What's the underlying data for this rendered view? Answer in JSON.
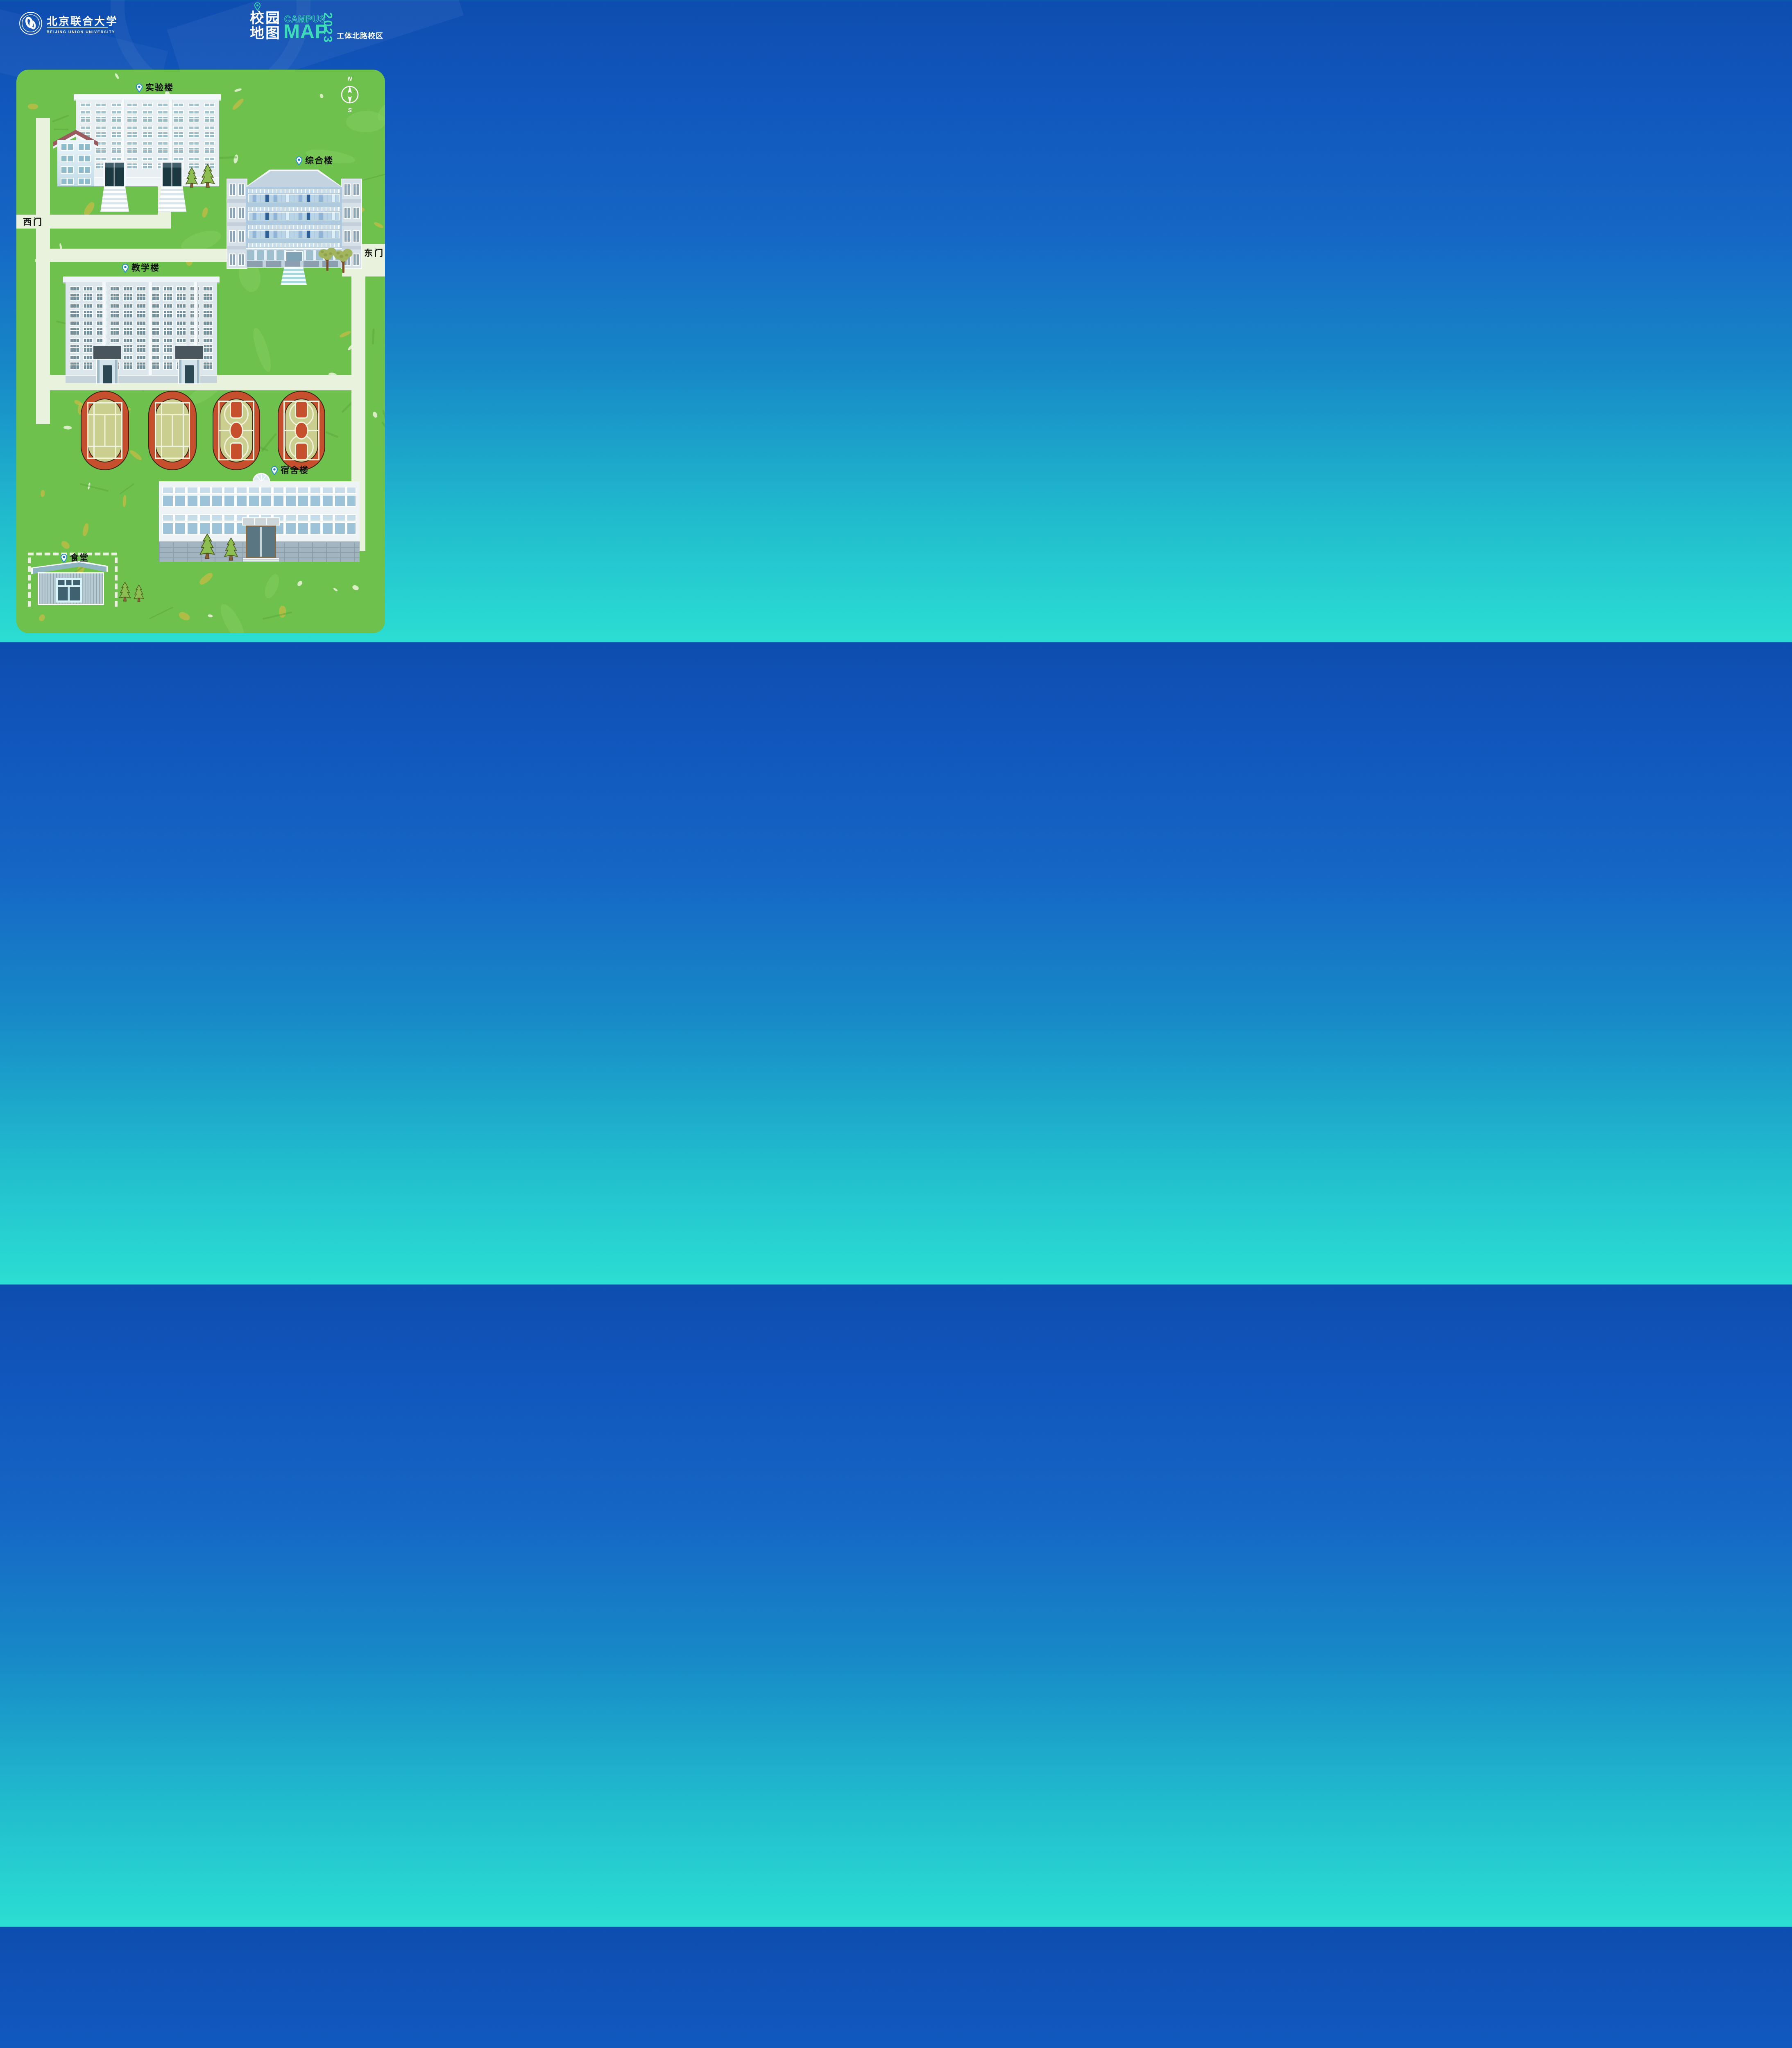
{
  "header": {
    "university_name_cn": "北京联合大学",
    "university_name_en": "BEIJING UNION UNIVERSITY",
    "title": {
      "cn_line1": "校园",
      "cn_line2": "地图",
      "en_word1": "CAMPUS",
      "en_word2": "MAP",
      "year": "2023",
      "campus": "工体北路校区"
    }
  },
  "map": {
    "compass": {
      "north": "N",
      "south": "S"
    },
    "gates": {
      "west": "西门",
      "east": "东门"
    },
    "buildings": {
      "laboratory": "实验楼",
      "complex": "综合楼",
      "teaching": "教学楼",
      "dormitory": "宿舍楼",
      "canteen": "食堂"
    }
  },
  "colors": {
    "background_top": "#1156BC",
    "background_bottom": "#2BDED3",
    "accent_teal": "#3EDBB8",
    "grass_green": "#6FC14E",
    "road_cream": "#E9F2DC",
    "track_red": "#C6502D",
    "court_khaki": "#CACE8E",
    "pin_blue": "#1B78C8"
  }
}
